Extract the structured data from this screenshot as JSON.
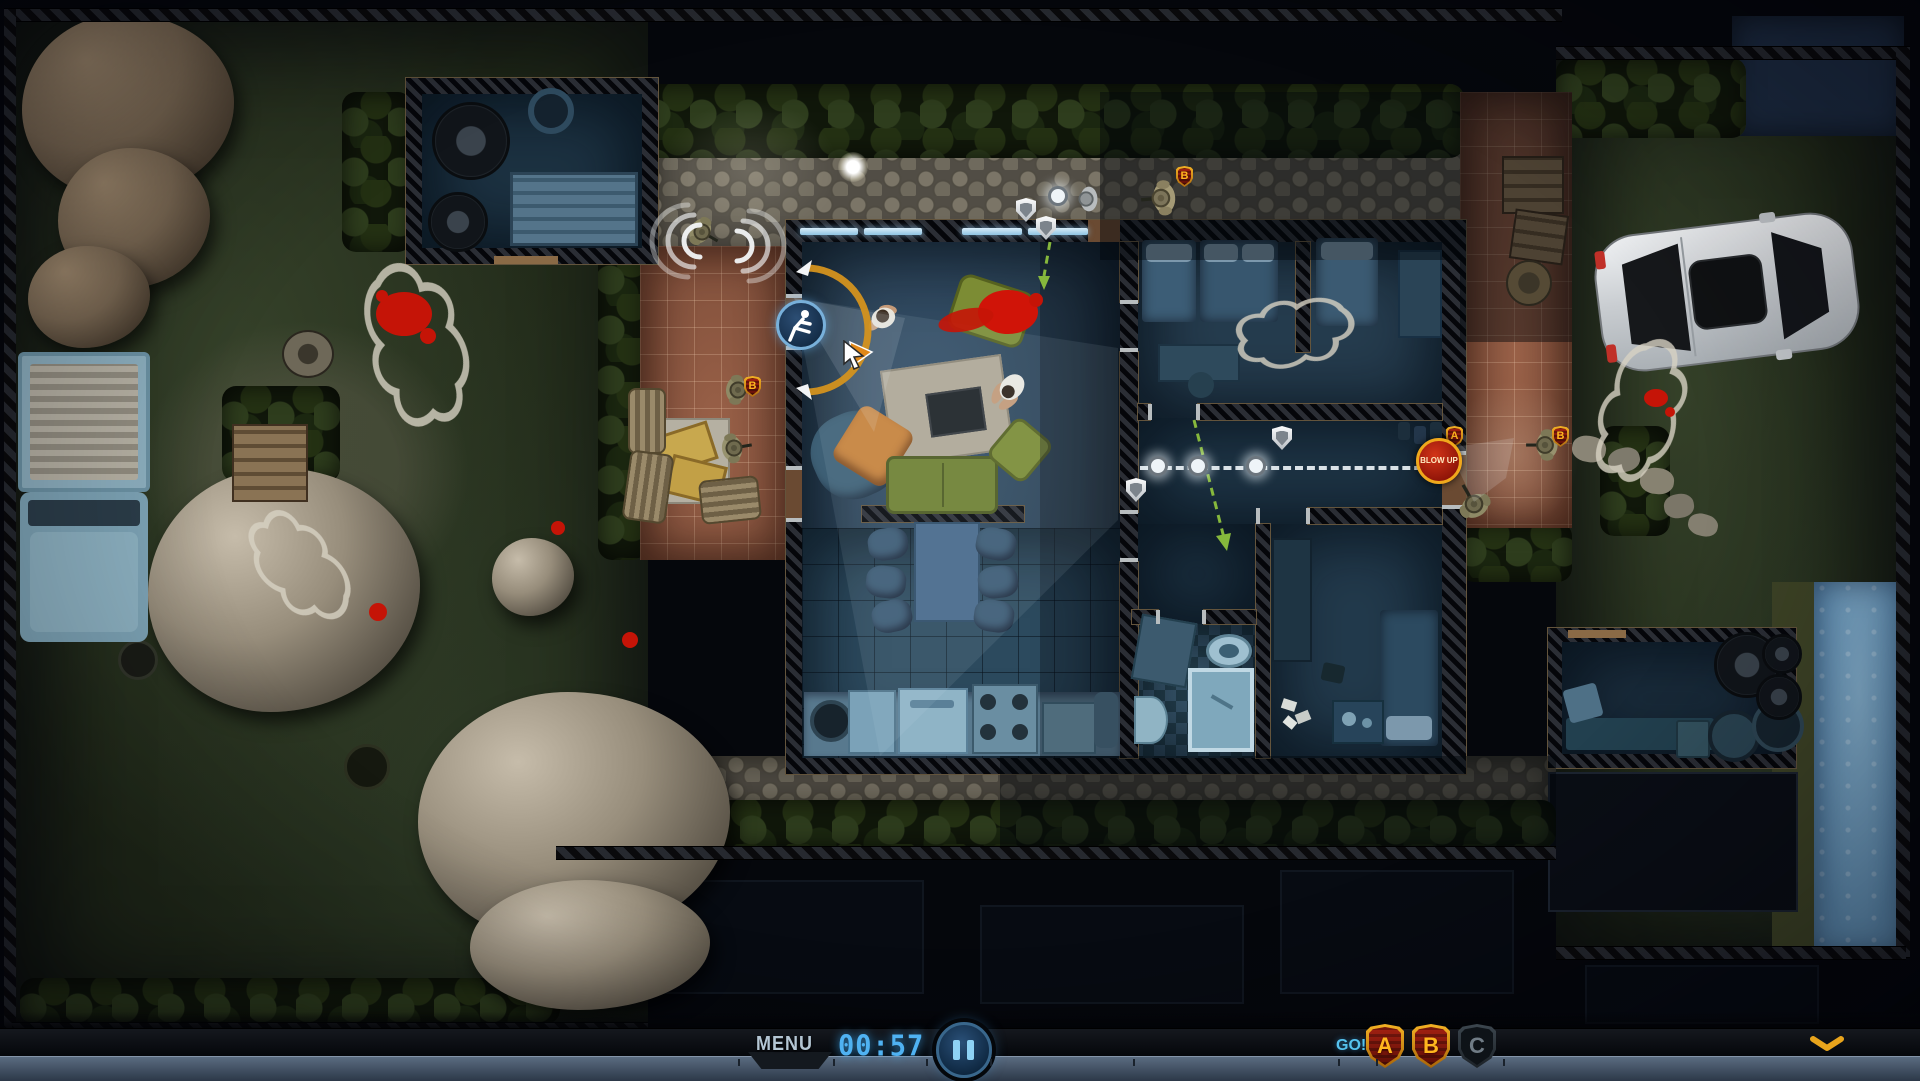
{
  "hud": {
    "menu_label": "MENU",
    "timer": "00:57",
    "go_label": "GO!",
    "squad_buttons": [
      {
        "label": "A",
        "active": true
      },
      {
        "label": "B",
        "active": true
      },
      {
        "label": "C",
        "active": false
      }
    ],
    "icons": {
      "pause": "pause-icon",
      "collapse": "chevron-down-icon"
    },
    "colors": {
      "timer_blue": "#4fb2f2",
      "go_blue": "#55c2ee",
      "menu_grey": "#b4c6d4",
      "badge_red": "#8a1810",
      "badge_gold": "#f0a81c",
      "badge_inactive": "#20262c",
      "chevron_gold": "#e8a41c"
    }
  },
  "map": {
    "demolition_order": {
      "label": "BLOW UP",
      "squad_label": "A",
      "color": "#c02010"
    },
    "squad_badges": [
      {
        "label": "B",
        "location": "left-patio"
      },
      {
        "label": "B",
        "location": "top-path"
      },
      {
        "label": "B",
        "location": "right-patio"
      }
    ],
    "icons": {
      "waypoint_shield": "shield-marker-icon",
      "breach": "breach-kick-icon",
      "waypoint_dot": "waypoint-dot",
      "facing_arc": "facing-arc",
      "sound_waves": "sound-waves-icon",
      "cursor": "cursor-arrow-icon",
      "patrol_arrow": "green-dashed-arrow"
    },
    "units": {
      "swat_troopers": 6,
      "civilians": 2
    }
  }
}
